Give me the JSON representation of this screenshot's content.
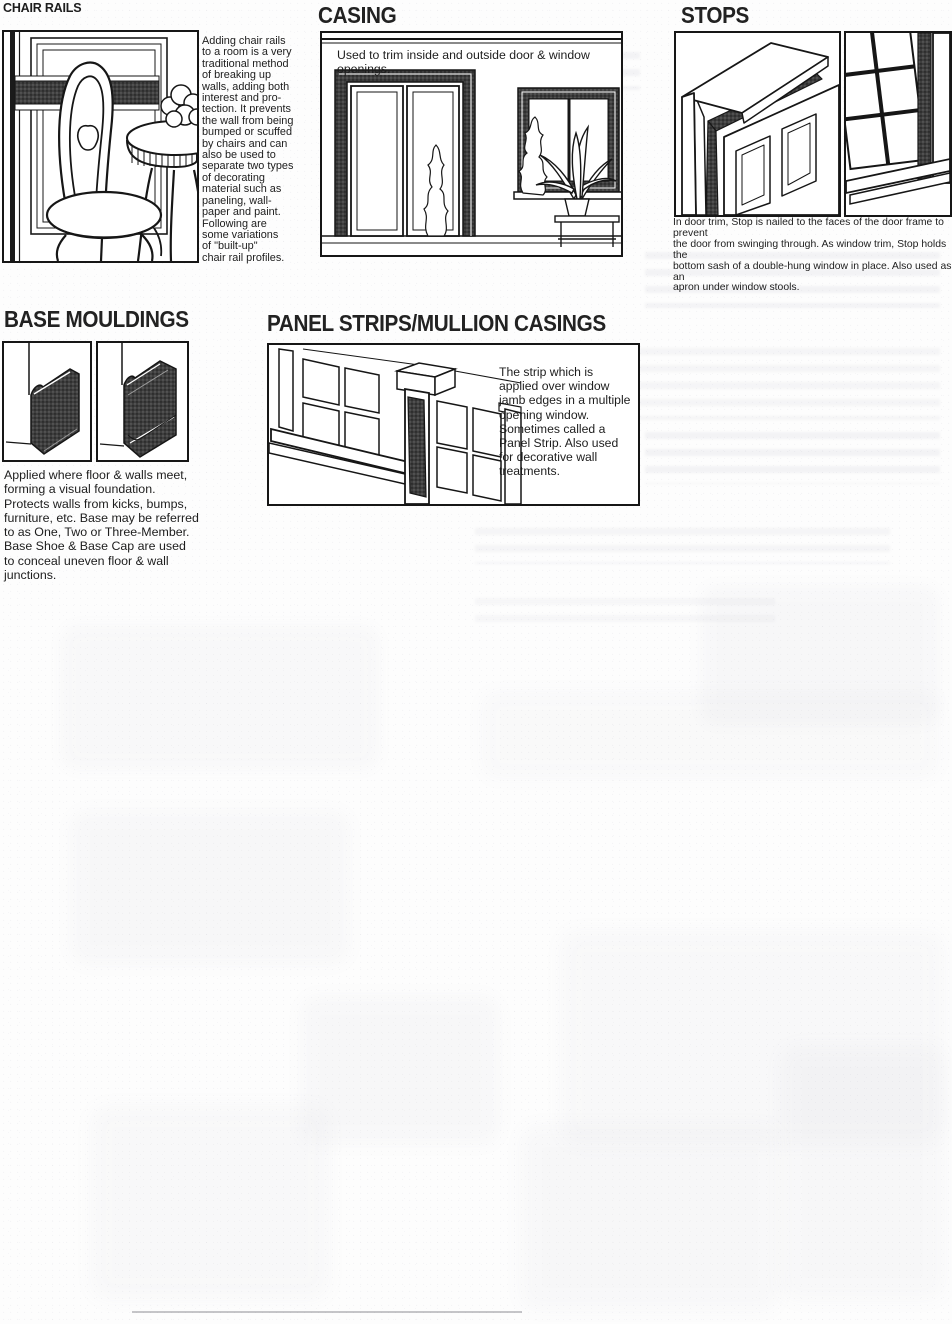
{
  "sections": {
    "chair_rails": {
      "title": "CHAIR RAILS",
      "body": "Adding chair rails\nto a room is a very\ntraditional method\nof breaking up\nwalls, adding both\ninterest and pro-\ntection. It prevents\nthe wall from being\nbumped or scuffed\nby chairs and can\nalso be used to\nseparate two types\nof decorating\nmaterial such as\npaneling, wall-\npaper and paint.\nFollowing are\nsome variations\nof \"built-up\"\nchair rail profiles."
    },
    "casing": {
      "title": "CASING",
      "caption": "Used to trim inside and outside door & window openings."
    },
    "stops": {
      "title": "STOPS",
      "caption": "In door trim, Stop is nailed to the faces of the door frame to prevent\nthe door from swinging through. As window trim, Stop holds the\nbottom sash of a double-hung window in place. Also used as an\napron under window stools."
    },
    "base_mouldings": {
      "title": "BASE MOULDINGS",
      "body": "Applied where floor & walls meet,\nforming a visual foundation.\nProtects walls from kicks, bumps,\nfurniture, etc. Base may be referred\nto as One, Two or Three-Member.\nBase Shoe & Base Cap are used\nto conceal uneven floor & wall\njunctions."
    },
    "panel_strips": {
      "title": "PANEL STRIPS/MULLION CASINGS",
      "body": "The strip which is\napplied over window\njamb edges in a multiple\nopening window.\nSometimes called a\nPanel Strip. Also used\nfor decorative wall\ntreatments."
    }
  },
  "illustrations": {
    "chair_rails": "room scene with chair, side table and dark chair-rail band on panelled wall",
    "casing": "doorway and window openings trimmed with dark casing",
    "stops_door": "door frame head with stop moulding strip",
    "stops_window": "double-hung window with stop moulding and stool",
    "base_left": "base moulding profile, perspective view",
    "base_right": "three-member base moulding profile, perspective view",
    "panel_strips": "multiple-opening window with mullion casing strip"
  },
  "colors": {
    "ink": "#1d1d1d",
    "moulding_dark": "#3e3e3e",
    "paper": "#fdfdfd"
  }
}
